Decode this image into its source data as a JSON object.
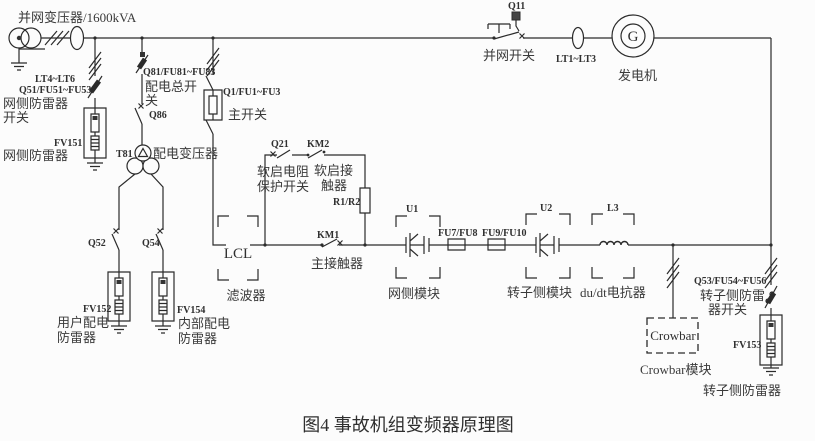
{
  "diagram": {
    "title": "并网变压器/1600kVA",
    "caption": "图4 事故机组变频器原理图",
    "labels": {
      "lt4": "LT4~LT6",
      "q51": "Q51/FU51~FU53",
      "q51d1": "网侧防雷器",
      "q51d2": "开关",
      "fv151": "FV151",
      "fv151d": "网侧防雷器",
      "q81": "Q81/FU81~FU83",
      "q81d1": "配电总开",
      "q81d2": "关",
      "q86": "Q86",
      "t81": "T81",
      "t81d": "配电变压器",
      "q1": "Q1/FU1~FU3",
      "q1d": "主开关",
      "q52": "Q52",
      "q54": "Q54",
      "fv152": "FV152",
      "fv152d1": "用户配电",
      "fv152d2": "防雷器",
      "fv154": "FV154",
      "fv154d1": "内部配电",
      "fv154d2": "防雷器",
      "lcl": "LCL",
      "lcld": "滤波器",
      "q21": "Q21",
      "q21d1": "软启电阻",
      "q21d2": "保护开关",
      "km2": "KM2",
      "km2d1": "软启接",
      "km2d2": "触器",
      "r1r2": "R1/R2",
      "km1": "KM1",
      "km1d": "主接触器",
      "u1": "U1",
      "u1d": "网侧模块",
      "fu78": "FU7/FU8",
      "fu910": "FU9/FU10",
      "u2": "U2",
      "u2d": "转子侧模块",
      "l3": "L3",
      "l3d": "du/dt电抗器",
      "q11": "Q11",
      "q11d": "并网开关",
      "lt1": "LT1~LT3",
      "g": "G",
      "gend": "发电机",
      "crowbar": "Crowbar",
      "crowbard": "Crowbar模块",
      "q53": "Q53/FU54~FU56",
      "q53d1": "转子侧防雷",
      "q53d2": "器开关",
      "fv153": "FV153",
      "fv153d": "转子侧防雷器"
    }
  }
}
